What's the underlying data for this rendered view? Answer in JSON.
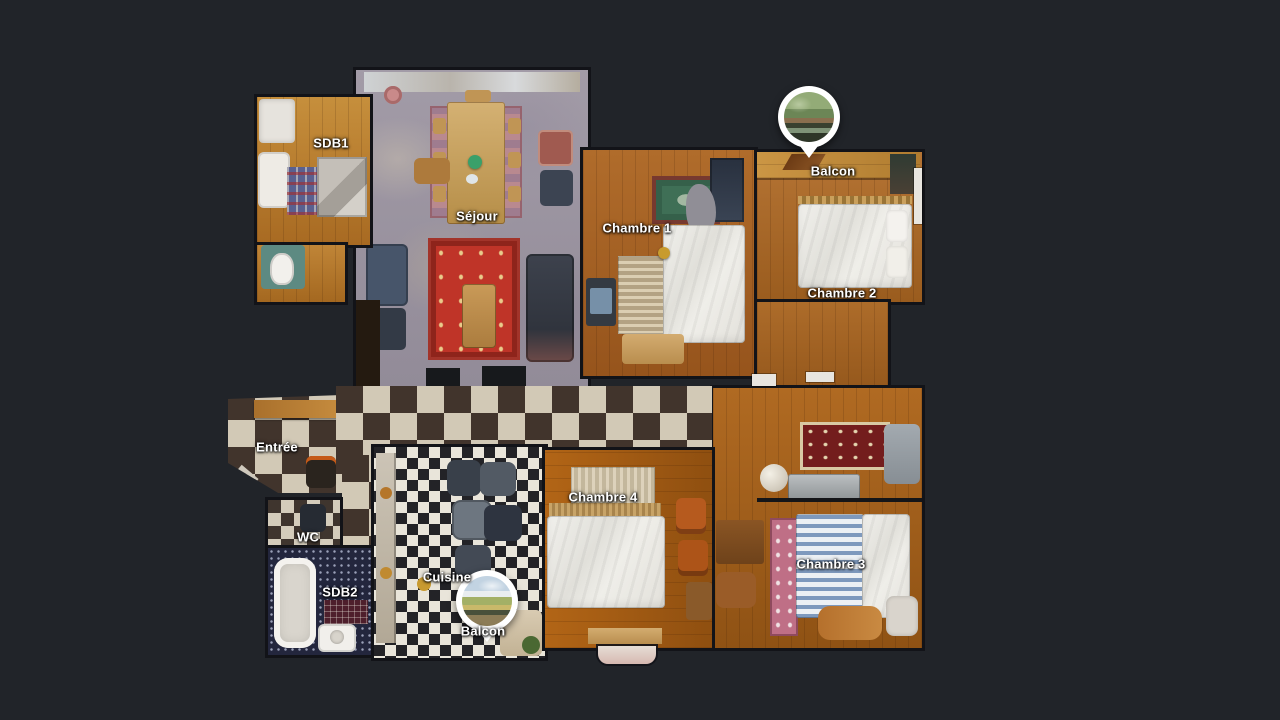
{
  "view": {
    "name": "apartment-dollhouse-floorplan",
    "background_color": "#212429"
  },
  "labels": {
    "sdb1": "SDB1",
    "sejour": "Séjour",
    "chambre1": "Chambre 1",
    "balcon_haut": "Balcon",
    "chambre2": "Chambre 2",
    "entree": "Entrée",
    "wc": "WC",
    "sdb2": "SDB2",
    "cuisine": "Cuisine",
    "balcon_bas": "Balcon",
    "chambre4": "Chambre 4",
    "chambre3": "Chambre 3"
  },
  "markers": [
    {
      "id": "balcon-haut",
      "kind": "panorama-photo-pin",
      "photo": "hedge-and-trees"
    },
    {
      "id": "balcon-bas",
      "kind": "panorama-photo-pin",
      "photo": "sky-and-treetops"
    }
  ],
  "palette": {
    "background": "#212429",
    "wood_warm": "#b06c2b",
    "checker_cream": "#d2c9b6",
    "checker_dark": "#41342c",
    "label_text": "#ffffff",
    "marker_ring": "#ffffff"
  }
}
